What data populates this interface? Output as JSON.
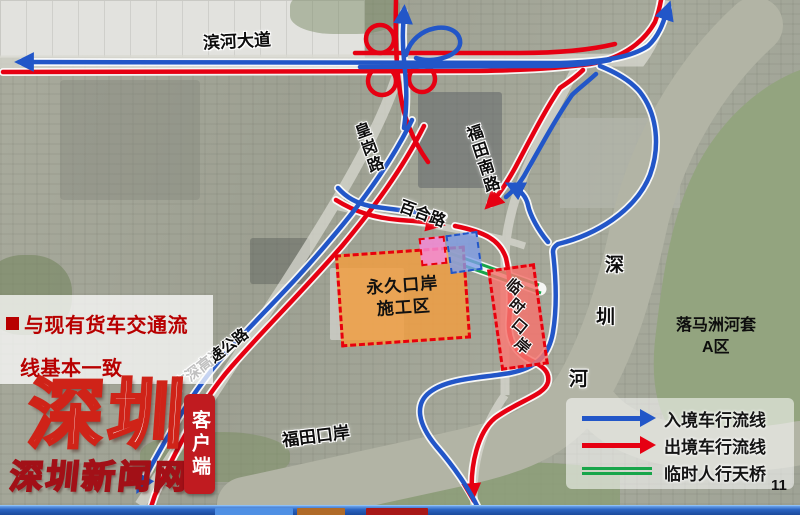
{
  "annotation": {
    "line1": "与现有货车交通流",
    "line2": "线基本一致"
  },
  "map_labels": {
    "binhe_avenue": "滨河大道",
    "huanggang_road": "皇岗路",
    "futian_south_road": "福田南路",
    "baihe_road": "百合路",
    "gs_expressway": "广深高速公路",
    "futian_port": "福田口岸",
    "river_char1": "深",
    "river_char2": "圳",
    "river_char3": "河",
    "lok_ma_chau_line1": "落马洲河套",
    "lok_ma_chau_line2": "A区"
  },
  "zones": {
    "permanent_line1": "永久口岸",
    "permanent_line2": "施工区",
    "temporary": "临时口岸"
  },
  "legend": {
    "inbound_label": "入境车行流线",
    "outbound_label": "出境车行流线",
    "footbridge_label": "临时人行天桥"
  },
  "branding": {
    "logo_main": "深圳",
    "logo_site": "深圳新闻网",
    "badge": "客户端"
  },
  "page_number": "11",
  "colors": {
    "inbound_blue": "#2256c8",
    "outbound_red": "#e60012",
    "footbridge_green": "#17a54a",
    "permanent_zone_orange": "#f09e42",
    "temporary_zone_red": "#f3746e",
    "annotation_red": "#b80000",
    "brand_red": "#c01b20"
  }
}
